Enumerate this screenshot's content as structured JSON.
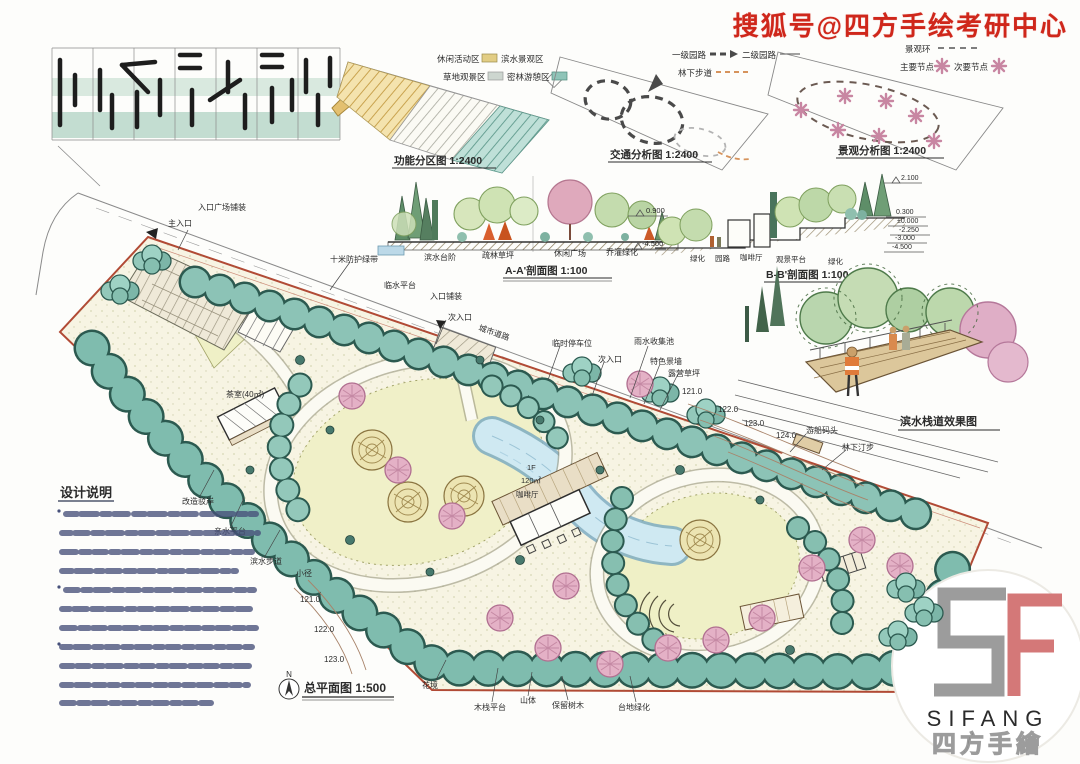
{
  "watermark": "搜狐号@四方手绘考研中心",
  "diagrams": {
    "function": {
      "caption": "功能分区图 1:2400",
      "legend": [
        "休闲活动区",
        "滨水景观区",
        "草地观景区",
        "密林游憩区"
      ],
      "legend_colors": [
        "#e2cd84",
        "#e8e4d4",
        "#cdd6cf",
        "#8fc4b8"
      ]
    },
    "traffic": {
      "caption": "交通分析图 1:2400",
      "legend": [
        "一级园路",
        "二级园路",
        "林下步道"
      ]
    },
    "landscape": {
      "caption": "景观分析图 1:2400",
      "legend": [
        "景观环",
        "主要节点",
        "次要节点"
      ]
    }
  },
  "sections": {
    "aa": {
      "caption": "A-A'剖面图 1:100",
      "labels": [
        "滨水台阶",
        "疏林草坪",
        "休闲广场",
        "乔灌绿化"
      ],
      "elevations": [
        "0.900",
        "-4.500"
      ]
    },
    "bb": {
      "caption": "B-B'剖面图 1:100",
      "labels": [
        "绿化",
        "园路",
        "咖啡厅",
        "观景平台",
        "绿化"
      ],
      "elevations": [
        "2.100",
        "0.300",
        "±0.000",
        "-2.250",
        "-3.000",
        "-4.500"
      ]
    }
  },
  "perspective": {
    "caption": "滨水栈道效果图"
  },
  "plan": {
    "caption": "总平面图 1:500",
    "north_label": "N",
    "building_coffee": [
      "1F",
      "120㎡",
      "咖啡厅"
    ],
    "labels": {
      "main_entry": "主入口",
      "entry_plaza": "入口广场铺装",
      "buffer_belt": "十米防护绿带",
      "water_platform": "临水平台",
      "entry_paving": "入口铺装",
      "side_entry_1": "次入口",
      "city_road": "城市道路",
      "parking": "临时停车位",
      "side_entry_2": "次入口",
      "rain_pool": "雨水收集池",
      "feature_wall": "特色景墙",
      "camp_lawn": "露营草坪",
      "boat_dock": "游船码头",
      "forest_steps": "林下汀步",
      "tea_house": "茶室(40㎡)",
      "revet": "改造驳岸",
      "hydro_platform": "亲水平台",
      "waterfront_walk": "滨水步道",
      "trail": "小径",
      "flower_border": "花境",
      "wood_deck": "木栈平台",
      "hill": "山体",
      "kept_trees": "保留树木",
      "terrace_green": "台地绿化"
    },
    "contours_ne": [
      "121.0",
      "122.0",
      "123.0",
      "124.0"
    ],
    "contours_sw": [
      "121.0",
      "122.0",
      "123.0"
    ]
  },
  "notes": {
    "title": "设计说明"
  },
  "logo": {
    "latin": "SIFANG",
    "cn": "四方手繪"
  }
}
